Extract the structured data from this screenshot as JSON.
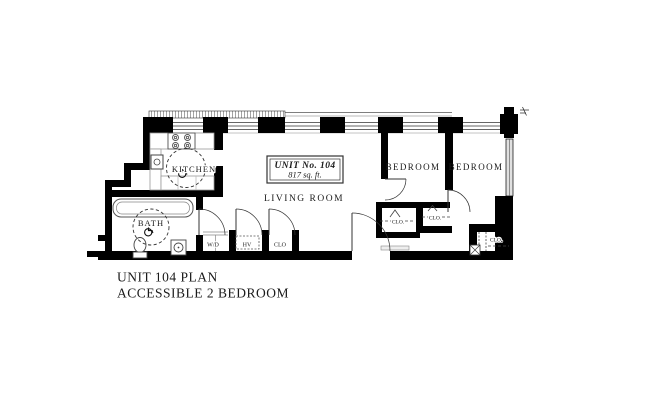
{
  "title_block": {
    "line1": "UNIT 104 PLAN",
    "line2": "ACCESSIBLE 2 BEDROOM"
  },
  "unit_info": {
    "line1": "UNIT No. 104",
    "line2": "817 sq. ft."
  },
  "rooms": {
    "kitchen": "KITCHEN",
    "bath": "BATH",
    "living": "LIVING ROOM",
    "bedroom1": "BEDROOM",
    "bedroom2": "BEDROOM"
  },
  "closets": {
    "washer_dryer": "W/D",
    "hvac": "HV",
    "hall_closet": "CLO",
    "bedroom1_closet_a": "CLO.",
    "bedroom1_closet_b": "CLO.",
    "bedroom2_closet": "CLO."
  },
  "icons": {
    "accessible": "wheelchair-icon"
  },
  "colors": {
    "wall": "#000000",
    "line": "#444444",
    "text": "#1a1a1a",
    "background": "#ffffff"
  }
}
